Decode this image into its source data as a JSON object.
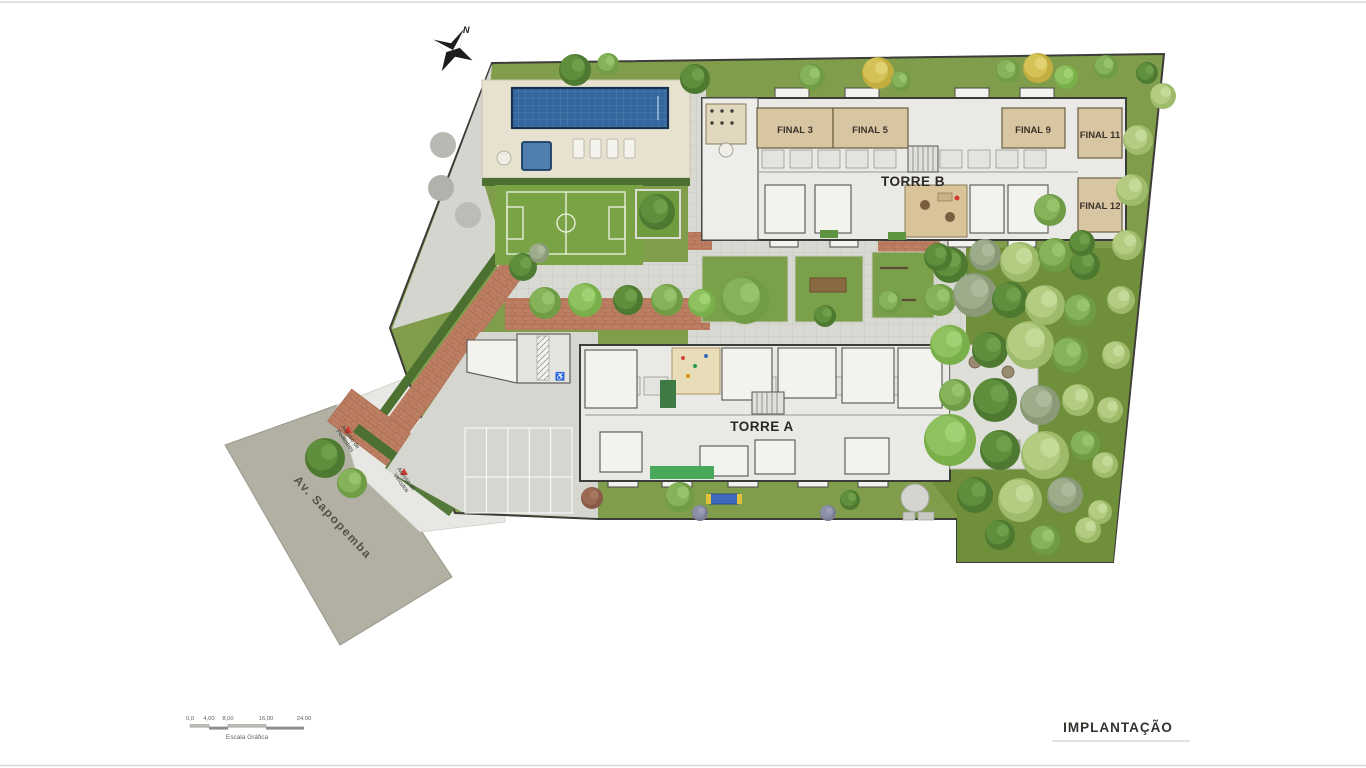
{
  "meta": {
    "kind": "architectural-site-plan"
  },
  "plan": {
    "towers": {
      "torre_a": "TORRE A",
      "torre_b": "TORRE B"
    },
    "units": [
      "FINAL 3",
      "FINAL 5",
      "FINAL 9",
      "FINAL 11",
      "FINAL 12"
    ],
    "street": "Av. Sapopemba",
    "access": {
      "pedestrian": [
        "Acesso de",
        "Pedestres"
      ],
      "vehicle": [
        "Acesso de",
        "Veículos"
      ]
    },
    "compass_n": "N",
    "scale_bar": {
      "ticks": [
        "0,0",
        "4,00",
        "8,00",
        "16,00",
        "24,00"
      ],
      "caption": "Escala Gráfica"
    },
    "sheet_title": "IMPLANTAÇÃO"
  },
  "colors": {
    "lawn": "#7f9d4a",
    "lawn_dark": "#6f8f3a",
    "field": "#6f9e3d",
    "pool": "#35679f",
    "pool_border": "#17314f",
    "deck": "#e7e2cf",
    "paver": "#d9d9d3",
    "brick": "#bd7f62",
    "road": "#b2afa3",
    "slab": "#e9e9e6",
    "wall": "#3c3c38",
    "unit_beige": "#d8c6a3",
    "hedge": "#4c7030",
    "concrete": "#d5d5d0",
    "accent_red": "#d23b2f",
    "text_dark": "#3b332a"
  }
}
